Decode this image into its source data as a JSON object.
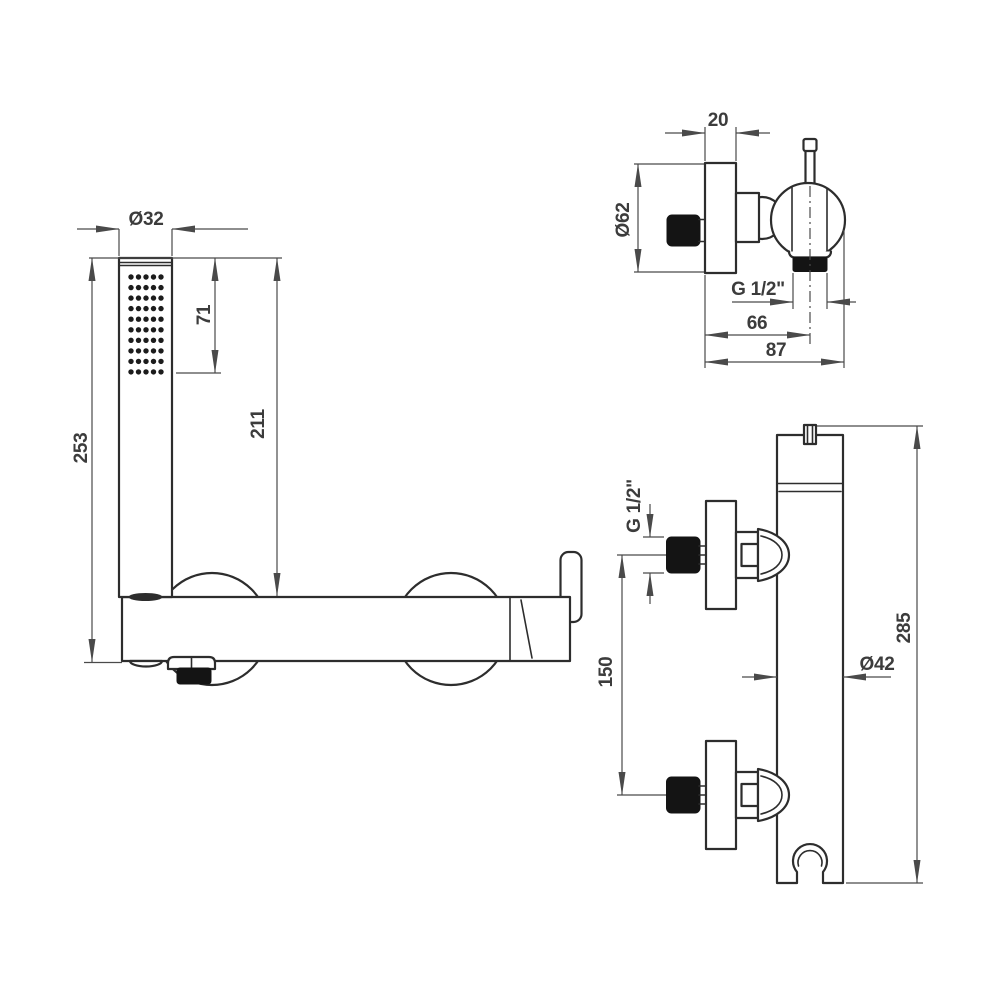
{
  "drawing_title": "shower-mixer-technical-drawing",
  "labels": {
    "front": {
      "head_diameter": "Ø32",
      "spray_length": "71",
      "head_height": "211",
      "total_height": "253"
    },
    "top": {
      "flange_depth": "20",
      "flange_diameter": "Ø62",
      "outlet_thread": "G 1/2\"",
      "outlet_offset": "66",
      "total_depth": "87"
    },
    "side": {
      "inlet_thread": "G 1/2\"",
      "inlet_spacing": "150",
      "body_diameter": "Ø42",
      "body_height": "285"
    }
  },
  "colors": {
    "outline": "#2d2d2d",
    "dimension": "#4a4a4a",
    "text": "#3c3c3c",
    "fill": "#ffffff",
    "solid_black": "#141414"
  }
}
